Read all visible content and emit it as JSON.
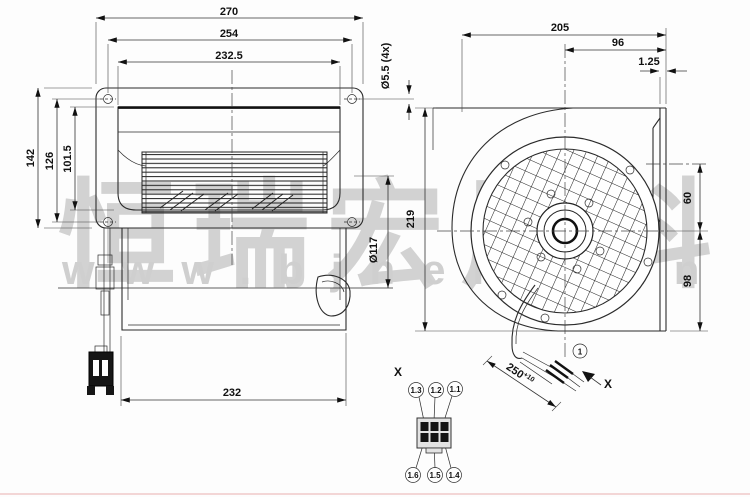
{
  "watermark": {
    "company_cn": "恒瑞宏晟科",
    "website": "www.bjhengrun"
  },
  "front_view": {
    "dim_width_outer": "270",
    "dim_width_holes": "254",
    "dim_width_inner": "232.5",
    "dim_hole_diameter": "Ø5.5 (4x)",
    "dim_height_outer": "142",
    "dim_height_holes": "126",
    "dim_height_inner": "101.5",
    "dim_impeller_diameter": "Ø117",
    "dim_depth": "232"
  },
  "side_view": {
    "dim_depth": "205",
    "dim_outlet_depth": "96",
    "dim_flange_gap": "1.25",
    "dim_height": "219",
    "dim_outlet_offset": "60",
    "dim_axis_height": "98",
    "cable_length": "250",
    "cable_tolerance": "+10",
    "cable_callout": "1",
    "section_label": "X"
  },
  "connector": {
    "section_label": "X",
    "pins_top": [
      "1.3",
      "1.2",
      "1.1"
    ],
    "pins_bottom": [
      "1.6",
      "1.5",
      "1.4"
    ]
  }
}
